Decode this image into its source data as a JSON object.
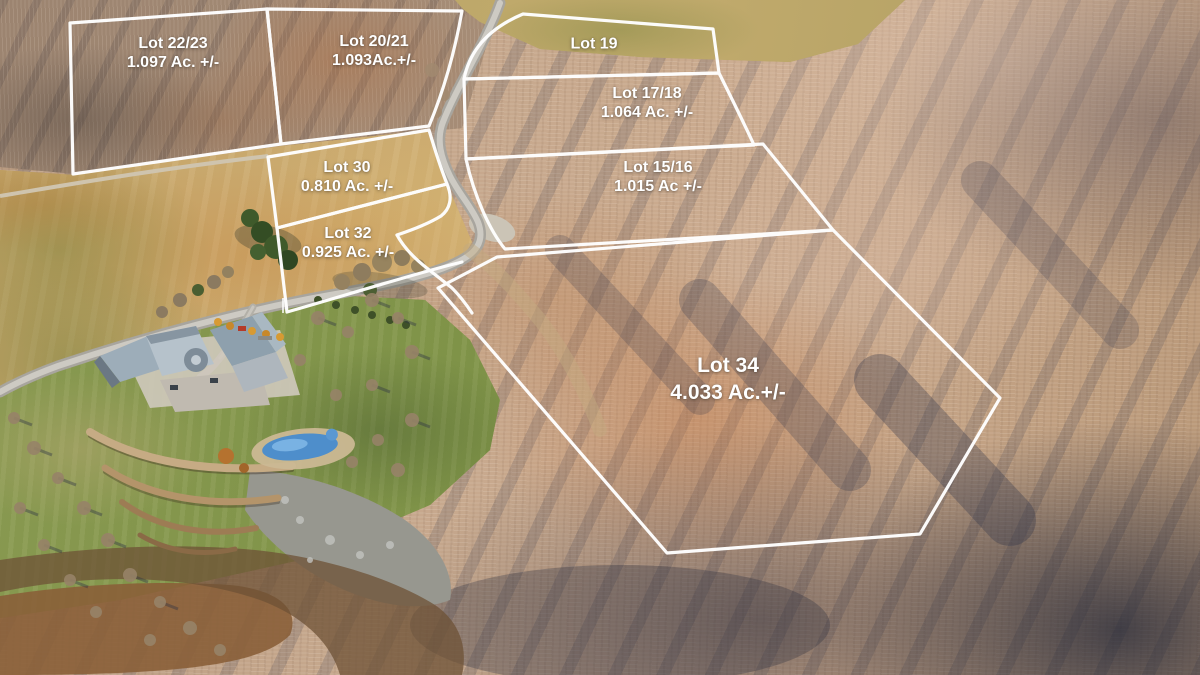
{
  "scene": {
    "type": "aerial-photo-with-lot-boundary-overlay",
    "boundary_color": "#ffffff",
    "label_color": "#ffffff"
  },
  "lots": [
    {
      "id": "lot-22-23",
      "name": "Lot 22/23",
      "acreage": "1.097 Ac. +/-"
    },
    {
      "id": "lot-20-21",
      "name": "Lot 20/21",
      "acreage": "1.093Ac.+/-"
    },
    {
      "id": "lot-19",
      "name": "Lot 19",
      "acreage": ""
    },
    {
      "id": "lot-17-18",
      "name": "Lot 17/18",
      "acreage": "1.064 Ac. +/-"
    },
    {
      "id": "lot-15-16",
      "name": "Lot 15/16",
      "acreage": "1.015 Ac +/-"
    },
    {
      "id": "lot-30",
      "name": "Lot 30",
      "acreage": "0.810 Ac. +/-"
    },
    {
      "id": "lot-32",
      "name": "Lot 32",
      "acreage": "0.925 Ac. +/-"
    },
    {
      "id": "lot-34",
      "name": "Lot 34",
      "acreage": "4.033 Ac.+/-"
    }
  ]
}
